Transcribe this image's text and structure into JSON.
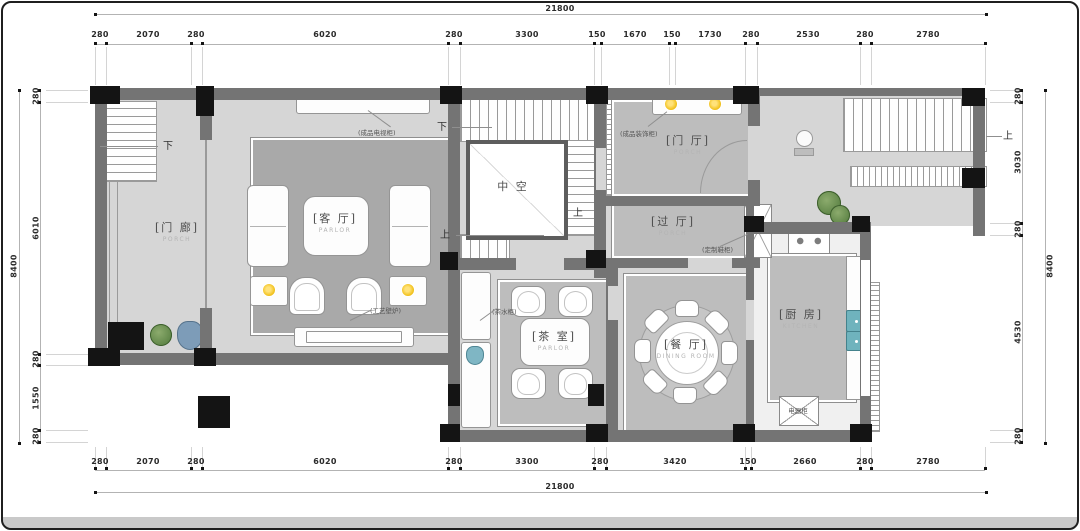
{
  "dimensions": {
    "top_total": "21800",
    "top": [
      "280",
      "2070",
      "280",
      "6020",
      "280",
      "3300",
      "150",
      "1670",
      "150",
      "1730",
      "280",
      "2530",
      "280",
      "2780"
    ],
    "bottom": [
      "280",
      "2070",
      "280",
      "6020",
      "280",
      "3300",
      "280",
      "3420",
      "150",
      "2660",
      "280",
      "2780"
    ],
    "bottom_total": "21800",
    "left": [
      "280",
      "6010",
      "280",
      "1550",
      "280"
    ],
    "left_total": "8400",
    "right": [
      "280",
      "3030",
      "280",
      "4530",
      "280"
    ],
    "right_total": "8400"
  },
  "rooms": {
    "porch": {
      "zh": "[门 廊]",
      "en": "PORCH"
    },
    "parlor": {
      "zh": "[客 厅]",
      "en": "PARLOR"
    },
    "void": {
      "zh": "中  空"
    },
    "entry": {
      "zh": "[门 厅]",
      "en": "PORCH"
    },
    "passage": {
      "zh": "[过 厅]",
      "en": "PORCH"
    },
    "tea_room": {
      "zh": "[茶 室]",
      "en": "PARLOR"
    },
    "dining": {
      "zh": "[餐 厅]",
      "en": "DINING ROOM"
    },
    "kitchen": {
      "zh": "[厨 房]",
      "en": "KITCHEN"
    }
  },
  "annotations": {
    "tv_cabinet": "(成品电视柜)",
    "fireplace": "(工艺壁炉)",
    "deco_cabinet": "(成品装饰柜)",
    "shoe_cabinet": "(定制鞋柜)",
    "tea_cabinet": "(茶水柜)",
    "appliance_cabinet": "电器柜"
  },
  "stair_marks": {
    "porch_down": "下",
    "stair_down": "下",
    "stair_up_left": "上",
    "stair_up_right": "上",
    "patio_up": "上"
  },
  "colors": {
    "wall": "#747474",
    "column": "#141414",
    "floor": "#d6d6d6",
    "rug": "#a9a9a9",
    "lamp": "#f2c21e",
    "plant": "#5f8a42",
    "appliance": "#6fb3bd"
  }
}
